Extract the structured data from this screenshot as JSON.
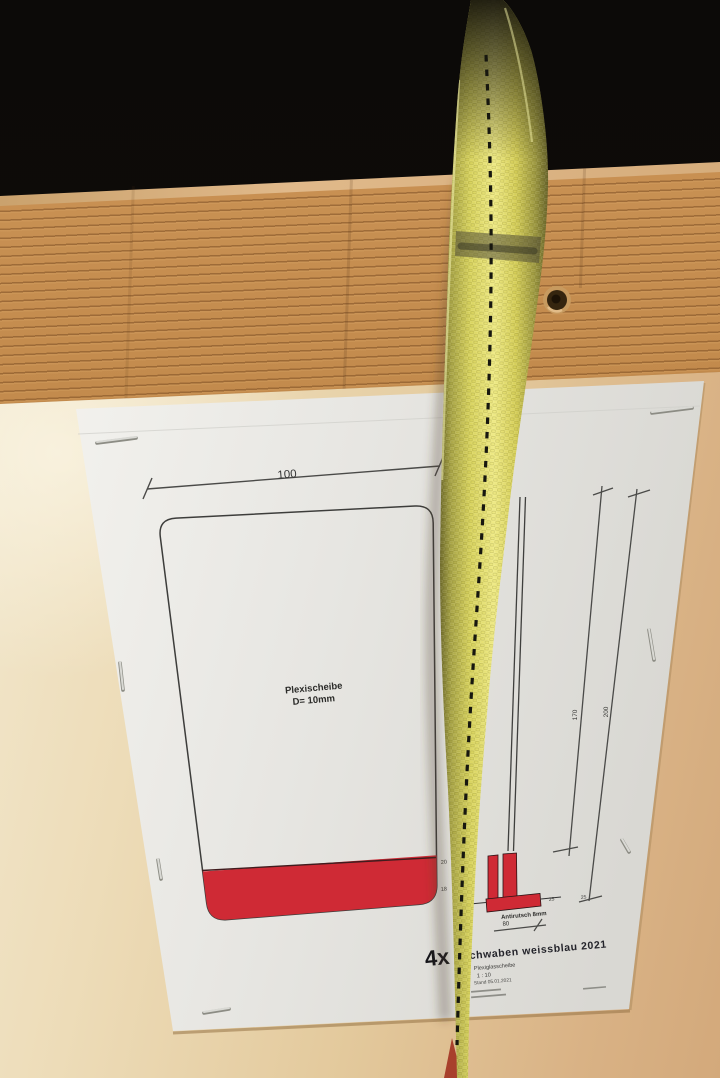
{
  "photo": {
    "drawing": {
      "dim_width": "100",
      "part_line1": "Plexischeibe",
      "part_line2": "D= 10mm",
      "dim_height_left": "170",
      "dim_height_right": "200",
      "dim_20": "20",
      "dim_18": "18",
      "dim_25_left": "25",
      "dim_25_right": "25",
      "antirutsch": "Antirutsch 8mm",
      "dim_80": "80"
    },
    "title_block": {
      "quantity": "4x",
      "title": "chwaben weissblau 2021",
      "part": "Plexiglasscheibe",
      "scale": "1 : 10",
      "date": "Stand 05.01.2021"
    },
    "colors": {
      "accent_red": "#cf2a35",
      "strap_yellow": "#e9e468",
      "plank_wood": "#c38b4d",
      "table_wood": "#e4cba0",
      "background_black": "#0c0a08",
      "paper": "#e9e8e4"
    }
  }
}
